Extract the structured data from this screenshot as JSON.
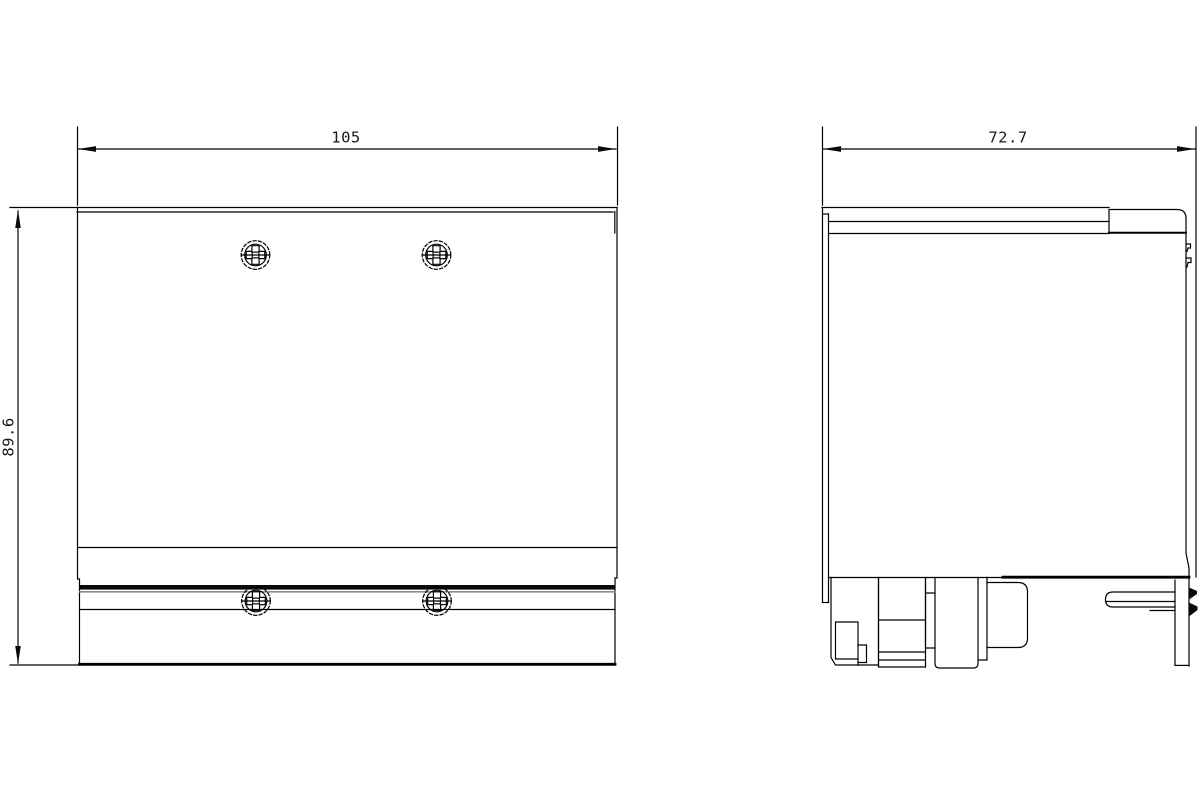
{
  "drawing": {
    "background_color": "#ffffff",
    "line_color": "#000000",
    "accent_gray": "#8a8a8a",
    "views": {
      "front_view": {
        "name": "front view",
        "width_dimension": {
          "label": "105"
        },
        "height_dimension": {
          "label": "89.6"
        },
        "screw_count": 4,
        "screw_icon": "pozidriv-screw-head"
      },
      "side_view": {
        "name": "side view",
        "depth_dimension": {
          "label": "72.7"
        },
        "features": [
          "top-cover-block",
          "terminal-blocks",
          "round-connector",
          "din-rail-bar",
          "mounting-clip"
        ]
      }
    }
  }
}
